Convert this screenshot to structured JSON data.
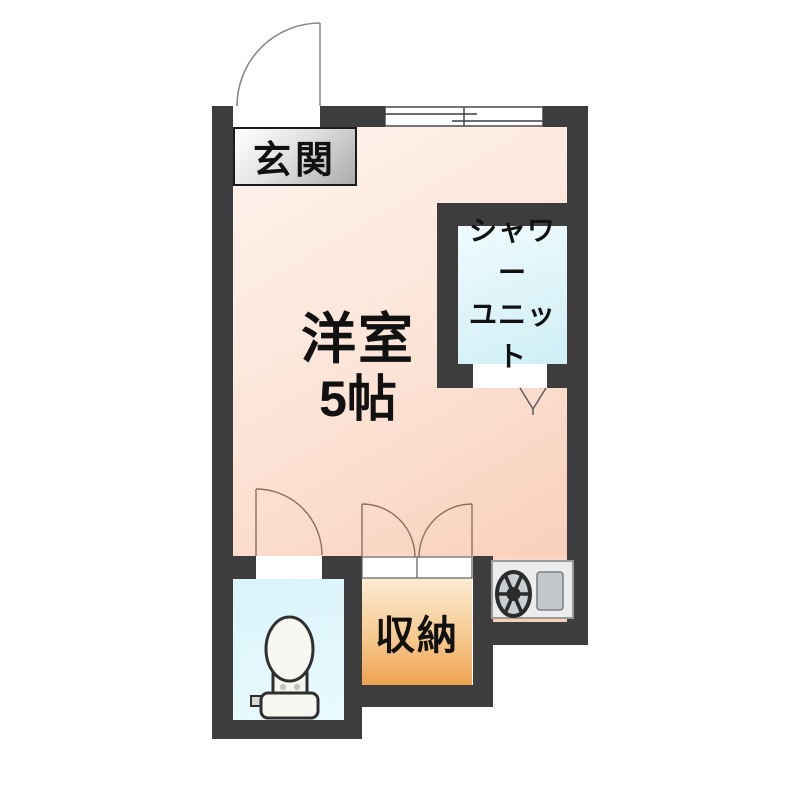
{
  "floor_plan": {
    "title": "studio-apartment-floor-plan",
    "wall_color": "#3d3d3d",
    "background": "#ffffff",
    "rooms": {
      "genkan": {
        "label": "玄関"
      },
      "main": {
        "name": "洋室",
        "size": "5帖",
        "floor_color_light": "#fef4ee",
        "floor_color_dark": "#f9cfba"
      },
      "shower": {
        "label_line1": "シャワー",
        "label_line2": "ユニット",
        "floor_color_light": "#f0fbfe",
        "floor_color_dark": "#cfeef6"
      },
      "storage": {
        "label": "収納",
        "floor_color_light": "#fcecd4",
        "floor_color_dark": "#efa352"
      },
      "toilet": {
        "floor_color": "#ddf6fb"
      },
      "kitchen": {
        "floor_color": "#fbd6c5"
      }
    },
    "icons": [
      "entrance-door-swing-icon",
      "sliding-window-icon",
      "shower-door-icon",
      "toilet-door-swing-icon",
      "storage-double-door-icon",
      "toilet-icon",
      "stove-icon"
    ]
  }
}
